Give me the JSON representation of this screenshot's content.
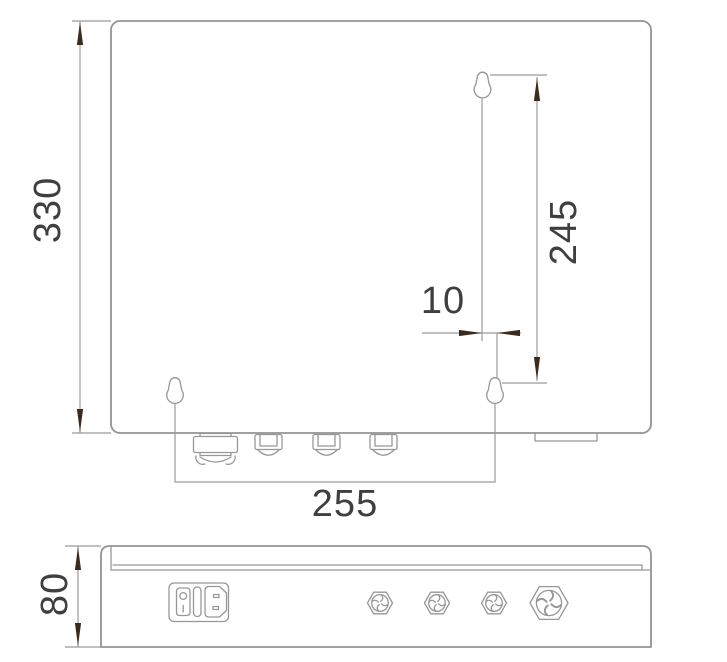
{
  "front_view": {
    "overall_height_label": "330",
    "mount_hole_vertical_spacing_label": "245",
    "mount_hole_offset_label": "10",
    "mount_hole_horizontal_spacing_label": "255"
  },
  "side_view": {
    "depth_label": "80"
  },
  "colors": {
    "object_line": "#949494",
    "dimension_line": "#9b9b9b",
    "text": "#3f3f3f",
    "arrowhead": "#3e2a1b",
    "background": "#ffffff"
  }
}
